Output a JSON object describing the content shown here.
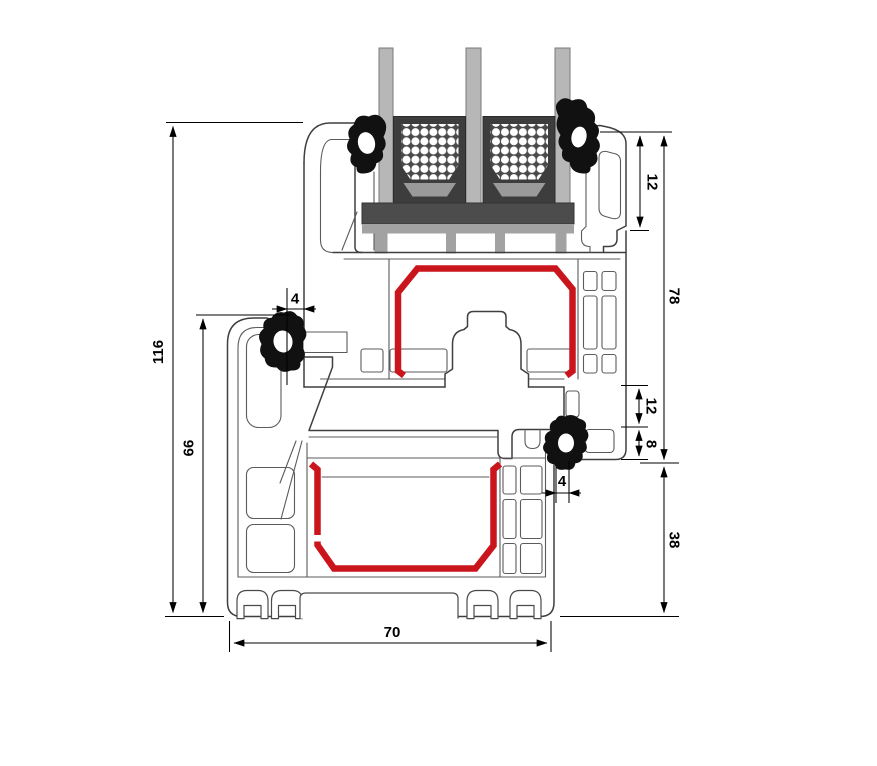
{
  "drawing": {
    "type": "technical-cross-section",
    "subject": "window-profile-section-with-triple-glazing",
    "dimension_labels": {
      "overall_height": "116",
      "frame_height": "66",
      "gasket_gap_left": "4",
      "glazing_edge_cover": "12",
      "sash_section_height": "78",
      "rebate_step": "12",
      "overlap": "8",
      "gasket_gap_right": "4",
      "frame_lower_section": "38",
      "profile_depth": "70"
    },
    "colors": {
      "steel_reinforcement": "#c9151b",
      "glass": "#b7b7b7",
      "spacer_body": "#3d3d3d",
      "spacer_inner": "#4a4a4a",
      "desiccant_band": "#9a9a9a",
      "glazing_block": "#4c4c4c",
      "glazing_bridge": "#a2a2a2",
      "gasket": "#111111",
      "profile_outline": "#3f3f3f",
      "dimension_lines": "#000000"
    }
  }
}
